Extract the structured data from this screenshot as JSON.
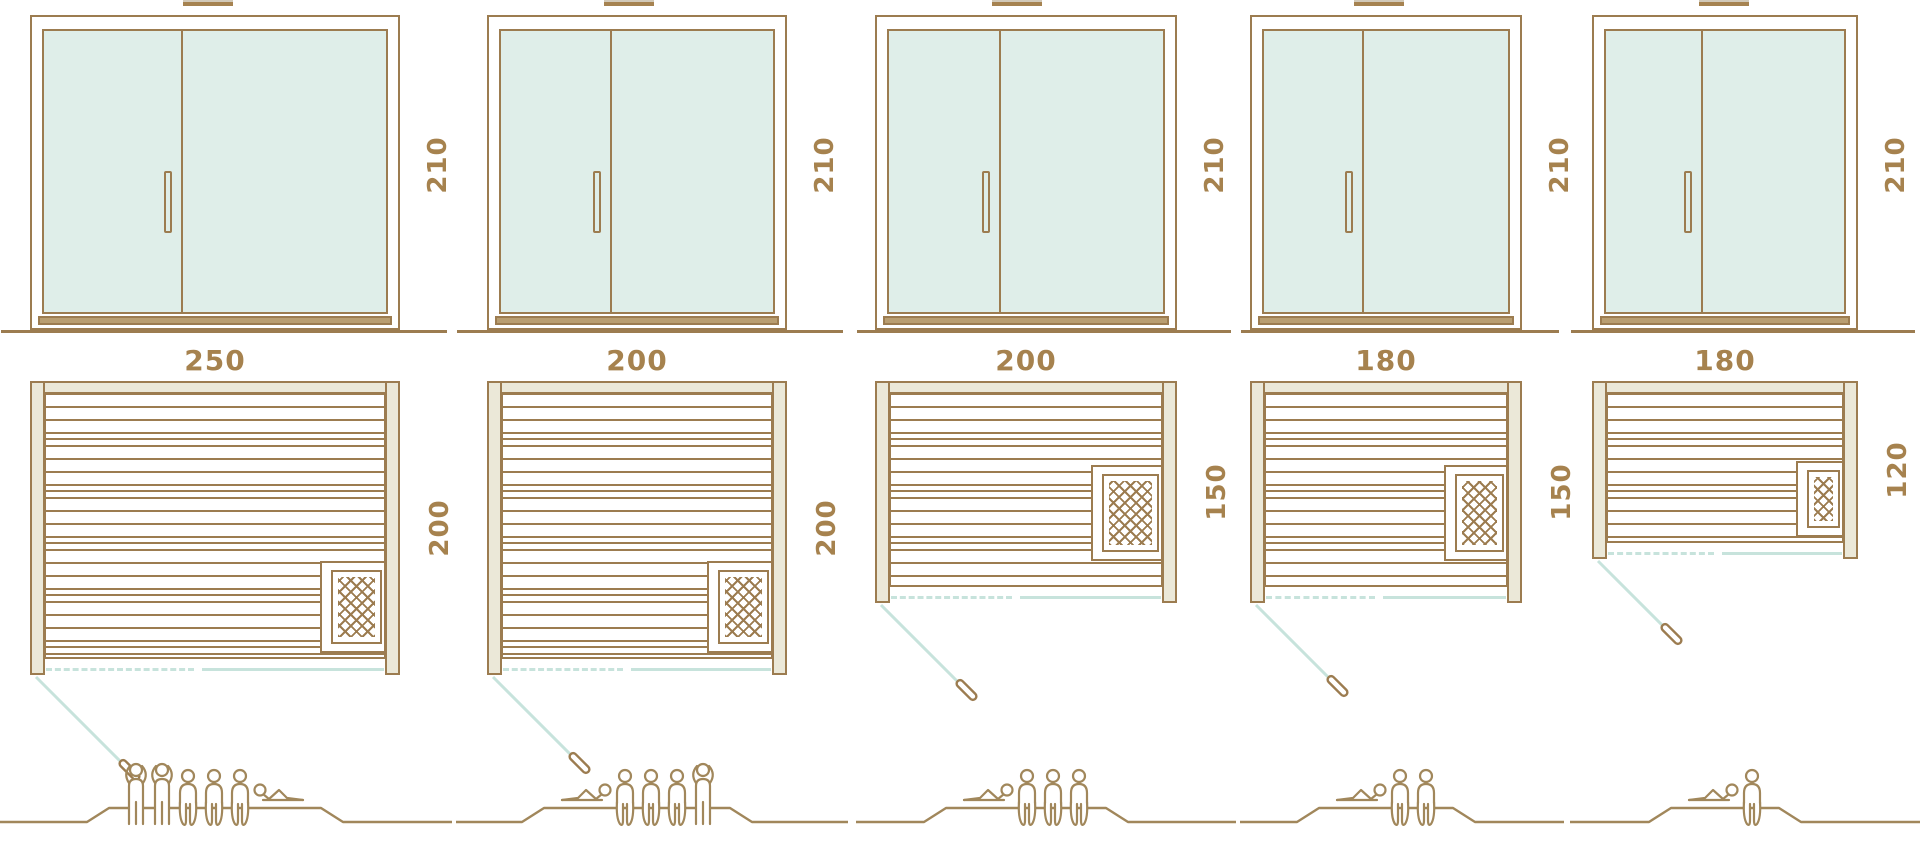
{
  "diagram_title": "sauna size comparison diagram",
  "colors": {
    "outline_brown": "#9c7c50",
    "glass_mint": "#dfeee9",
    "frame_beige": "#ebe8d8",
    "door_swing_blue": "#c7e3dc",
    "dimension_text": "#a6824e"
  },
  "columns": [
    {
      "name": "sauna-250x200",
      "door": {
        "height_label": "210"
      },
      "plan": {
        "width_label": "250",
        "depth_label": "200"
      },
      "capacity": {
        "standing": 2,
        "sitting": 3,
        "lying": 1,
        "arrangement": [
          "standing",
          "standing",
          "sitting",
          "sitting",
          "sitting",
          "lying-flip"
        ]
      }
    },
    {
      "name": "sauna-200x200",
      "door": {
        "height_label": "210"
      },
      "plan": {
        "width_label": "200",
        "depth_label": "200"
      },
      "capacity": {
        "standing": 1,
        "sitting": 3,
        "lying": 1,
        "arrangement": [
          "lying",
          "sitting",
          "sitting",
          "sitting",
          "standing"
        ]
      }
    },
    {
      "name": "sauna-200x150",
      "door": {
        "height_label": "210"
      },
      "plan": {
        "width_label": "200",
        "depth_label": "150"
      },
      "capacity": {
        "standing": 0,
        "sitting": 3,
        "lying": 1,
        "arrangement": [
          "lying",
          "sitting",
          "sitting",
          "sitting"
        ]
      }
    },
    {
      "name": "sauna-180x150",
      "door": {
        "height_label": "210"
      },
      "plan": {
        "width_label": "180",
        "depth_label": "150"
      },
      "capacity": {
        "standing": 0,
        "sitting": 2,
        "lying": 1,
        "arrangement": [
          "lying",
          "sitting",
          "sitting"
        ]
      }
    },
    {
      "name": "sauna-180x120",
      "door": {
        "height_label": "210"
      },
      "plan": {
        "width_label": "180",
        "depth_label": "120"
      },
      "capacity": {
        "standing": 0,
        "sitting": 1,
        "lying": 1,
        "arrangement": [
          "lying",
          "sitting"
        ]
      }
    }
  ]
}
